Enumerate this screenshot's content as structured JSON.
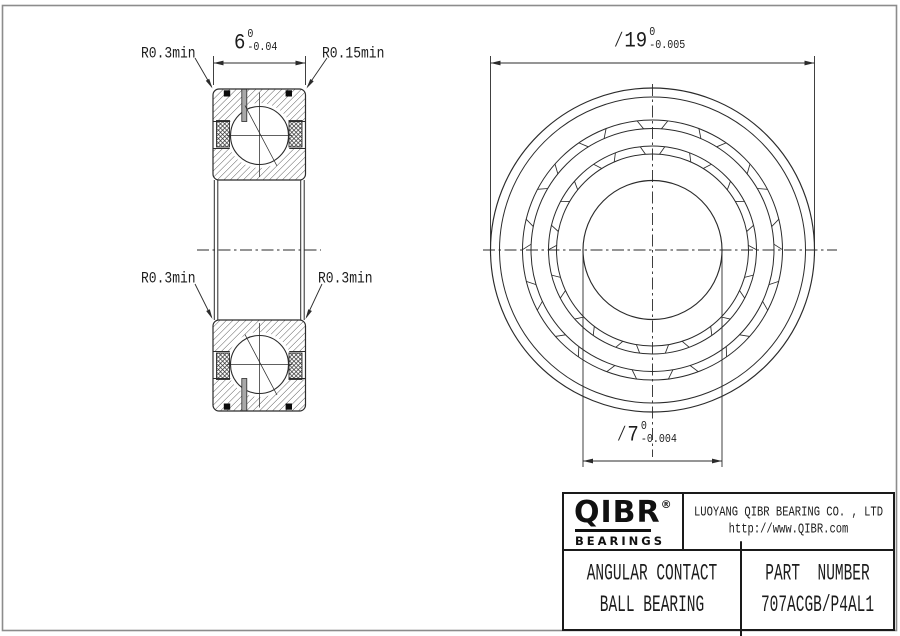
{
  "sheet": {
    "background": "#ffffff",
    "frame_color": "#8c8c8c",
    "line_color": "#2b2b2b"
  },
  "section_view": {
    "corner_labels": {
      "top_left": "R0.3min",
      "top_right": "R0.15min",
      "mid_left": "R0.3min",
      "mid_right": "R0.3min"
    },
    "width_dim": {
      "value": "6",
      "tol_upper": "0",
      "tol_lower": "-0.04"
    }
  },
  "front_view": {
    "outer_dia": {
      "value": "∕19",
      "tol_upper": "0",
      "tol_lower": "-0.005"
    },
    "bore_dia": {
      "value": "∕7",
      "tol_upper": "0",
      "tol_lower": "-0.004"
    }
  },
  "title_block": {
    "logo_text": "QIBR",
    "logo_reg": "®",
    "logo_sub": "BEARINGS",
    "company": "LUOYANG QIBR BEARING CO. , LTD",
    "website": "http://www.QIBR.com",
    "product_line1": "ANGULAR CONTACT",
    "product_line2": "BALL BEARING",
    "part_label": "PART  NUMBER",
    "part_value": "707ACGB/P4AL1"
  }
}
